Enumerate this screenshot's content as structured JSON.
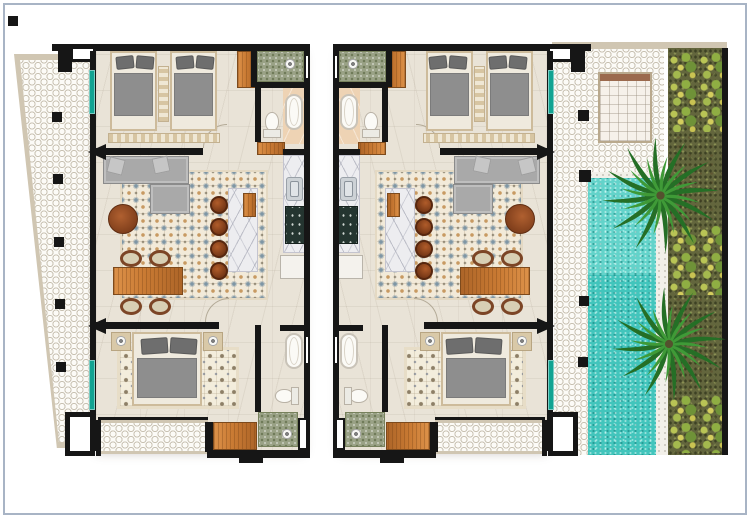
{
  "scene": {
    "type": "architectural floor plan, top-down render",
    "units": [
      {
        "id": "unit-left",
        "mirrored": false
      },
      {
        "id": "unit-right",
        "mirrored": true
      }
    ],
    "rooms_per_unit": [
      "twin-bedroom",
      "bathroom",
      "kitchen",
      "living-dining",
      "master-bedroom",
      "second-bathroom",
      "balcony",
      "entry"
    ],
    "furniture_per_unit": {
      "twin_beds": 2,
      "king_bed": 1,
      "sofa": 1,
      "dining_chairs": 4,
      "bar_stools": 4,
      "bathtubs": 2,
      "toilets": 2,
      "showers": 2,
      "wardrobes": 3
    },
    "outdoor": {
      "left_terrace_columns": 5,
      "pool_side_columns": 4,
      "palm_trees": 2,
      "shrub_clusters": 3,
      "daybeds": 1,
      "pool": true
    }
  },
  "colors": {
    "frame": "#a8b4c5",
    "wall": "#161616",
    "floor": "#e9e3d7",
    "terrace_tile_line": "#c8c1b2",
    "terrace_border": "#d0c6b2",
    "teal_door": "#12a392",
    "pool": "#42c5bc",
    "pool_light": "#63d3ca",
    "garden": "#63663d",
    "palm_dark": "#256f26",
    "palm_light": "#3f9a37",
    "wood": "#c97a33",
    "sofa": "#a9a9a9",
    "shower_tile": "#9aa286",
    "shower_dot": "#6f7a58",
    "bath_floor": "#eed3b4",
    "marble": "#ededf0",
    "stove": "#243530",
    "rug_base": "#f2ead9",
    "rug_motif_blue": "#7e96a5",
    "rug_motif_orange": "#c89a62",
    "bed_duvet": "#8e8e8e",
    "bed_pillow": "#6e6e6e",
    "bed_frame": "#cdbb9b",
    "stool": "#6f3314",
    "coffee_table": "#7c3c1a",
    "daybed": "#f6f1ea"
  }
}
